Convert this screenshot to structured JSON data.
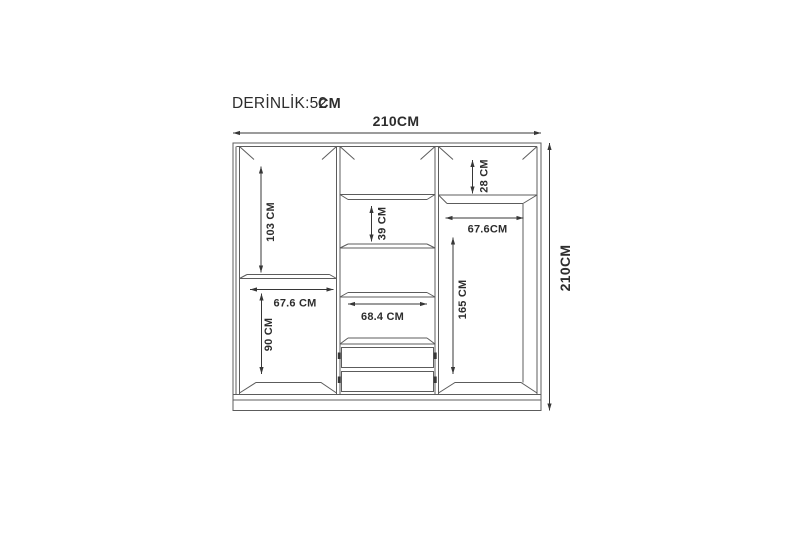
{
  "diagram": {
    "type": "wardrobe-technical-drawing",
    "depth": {
      "label": "DERİNLİK:52",
      "unit": "CM"
    },
    "overall": {
      "width": "210CM",
      "height": "210CM"
    },
    "sections": {
      "left_upper_height": "103 CM",
      "left_lower_width": "67.6 CM",
      "left_lower_height": "90 CM",
      "middle_shelf_gap": "39 CM",
      "middle_width": "68.4 CM",
      "right_top_shelf": "28 CM",
      "right_width": "67.6CM",
      "right_height": "165 CM"
    }
  },
  "colors": {
    "bg": "#ffffff",
    "line": "#5c5c5c",
    "dim": "#373737",
    "text": "#2d2d2d"
  }
}
